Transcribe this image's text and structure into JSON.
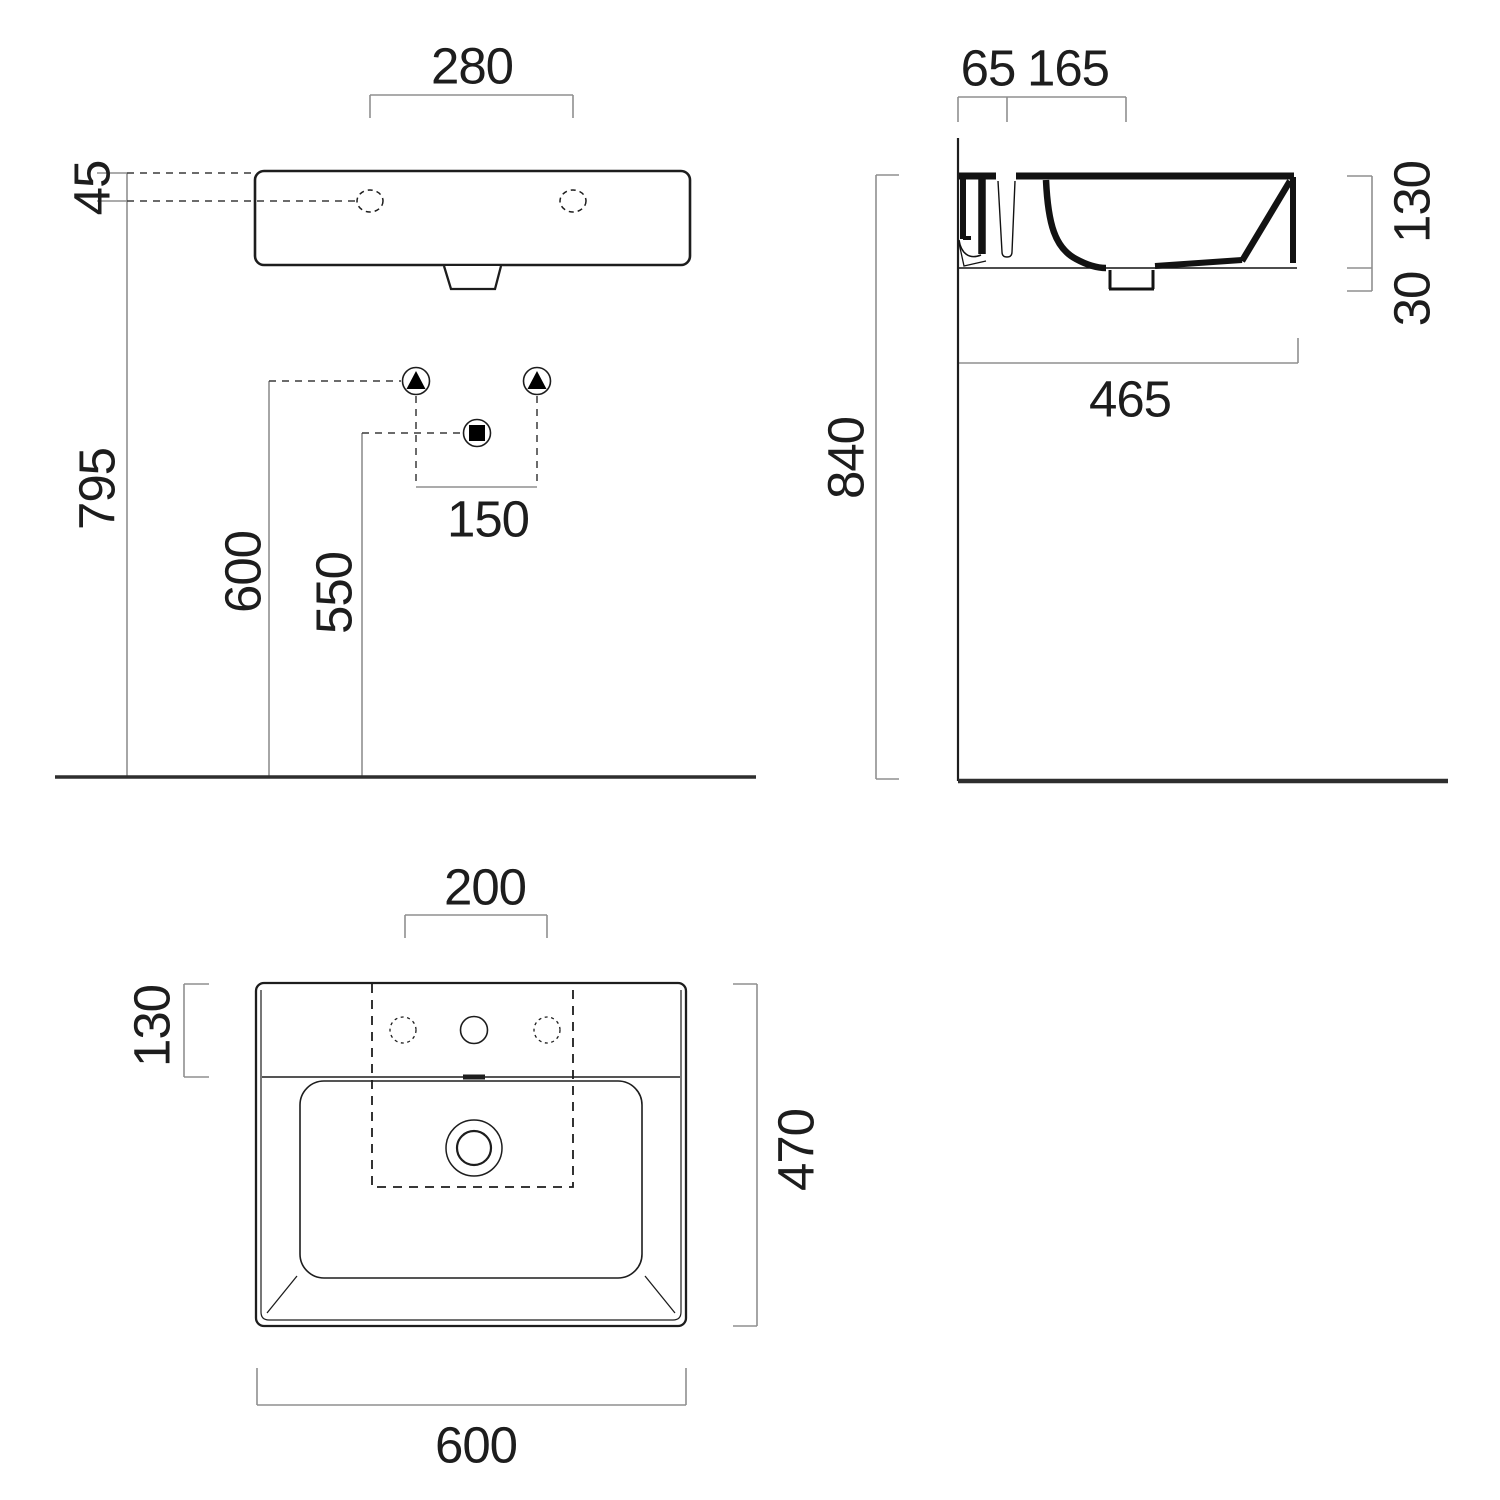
{
  "colors": {
    "ink": "#1d1d1d",
    "dimension_line": "#8f8f8f",
    "floor_line": "#2e2e2e",
    "background": "#ffffff"
  },
  "front_view": {
    "dim_280": "280",
    "dim_45": "45",
    "dim_795": "795",
    "dim_600": "600",
    "dim_550": "550",
    "dim_150": "150"
  },
  "side_view": {
    "dim_65": "65",
    "dim_165": "165",
    "dim_840": "840",
    "dim_130": "130",
    "dim_30": "30",
    "dim_465": "465"
  },
  "plan_view": {
    "dim_200": "200",
    "dim_130": "130",
    "dim_470": "470",
    "dim_600": "600"
  }
}
